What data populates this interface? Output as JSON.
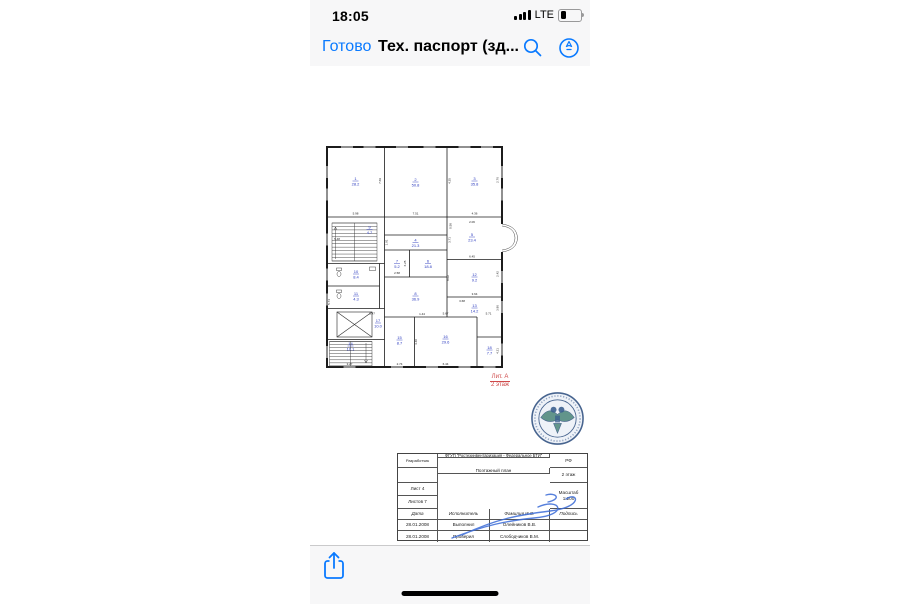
{
  "status_bar": {
    "time": "18:05",
    "network": "LTE",
    "battery_level": 0.3
  },
  "nav_bar": {
    "done_label": "Готово",
    "title": "Тех. паспорт (зд..."
  },
  "plan": {
    "floor_label_line1": "Лит. А",
    "floor_label_line2": "2 этаж",
    "label_color": "#cf4a4a",
    "room_label_color": "#2b3bbf",
    "rooms": [
      {
        "n": "1",
        "a": "28.2",
        "x": 67,
        "y": 78
      },
      {
        "n": "2",
        "a": "50.8",
        "x": 187,
        "y": 80
      },
      {
        "n": "3",
        "a": "35.8",
        "x": 305,
        "y": 78
      },
      {
        "n": "4",
        "a": "21.3",
        "x": 187,
        "y": 201
      },
      {
        "n": "5",
        "a": "23.4",
        "x": 300,
        "y": 190
      },
      {
        "n": "6",
        "a": "18.8",
        "x": 212,
        "y": 243
      },
      {
        "n": "7",
        "a": "5.2",
        "x": 150,
        "y": 243
      },
      {
        "n": "8",
        "a": "36.9",
        "x": 187,
        "y": 308
      },
      {
        "n": "9",
        "a": "4.7",
        "x": 95,
        "y": 175
      },
      {
        "n": "10",
        "a": "8.4",
        "x": 68,
        "y": 264
      },
      {
        "n": "11",
        "a": "4.3",
        "x": 68,
        "y": 308
      },
      {
        "n": "12",
        "a": "9.2",
        "x": 305,
        "y": 270
      },
      {
        "n": "13",
        "a": "14.2",
        "x": 305,
        "y": 332
      },
      {
        "n": "14",
        "a": "10.1",
        "x": 57,
        "y": 408
      },
      {
        "n": "15",
        "a": "8.7",
        "x": 155,
        "y": 396
      },
      {
        "n": "16",
        "a": "29.6",
        "x": 247,
        "y": 394
      },
      {
        "n": "17",
        "a": "10.0",
        "x": 112,
        "y": 362
      },
      {
        "n": "18",
        "a": "7.7",
        "x": 335,
        "y": 416
      }
    ],
    "dims": [
      {
        "v": "5.98",
        "x": 67,
        "y": 145
      },
      {
        "v": "7.69",
        "x": 118,
        "y": 78,
        "r": -90
      },
      {
        "v": "7.51",
        "x": 187,
        "y": 145
      },
      {
        "v": "1.91",
        "x": 131,
        "y": 201,
        "r": -90
      },
      {
        "v": "4.25",
        "x": 257,
        "y": 78,
        "r": -90
      },
      {
        "v": "2.76",
        "x": 353,
        "y": 76,
        "r": -90
      },
      {
        "v": "4.36",
        "x": 305,
        "y": 145
      },
      {
        "v": "5.48",
        "x": 30,
        "y": 196
      },
      {
        "v": "1.47",
        "x": 100,
        "y": 345
      },
      {
        "v": "2.06",
        "x": 300,
        "y": 162
      },
      {
        "v": "0.58",
        "x": 259,
        "y": 168,
        "r": -90
      },
      {
        "v": "3.71",
        "x": 257,
        "y": 196,
        "r": -90
      },
      {
        "v": "6.45",
        "x": 300,
        "y": 231
      },
      {
        "v": "6.25",
        "x": 168,
        "y": 243,
        "r": -90
      },
      {
        "v": "2.58",
        "x": 150,
        "y": 264
      },
      {
        "v": "3.64",
        "x": 305,
        "y": 306
      },
      {
        "v": "2.42",
        "x": 353,
        "y": 264,
        "r": -90
      },
      {
        "v": "8.02",
        "x": 254,
        "y": 272,
        "r": -90
      },
      {
        "v": "3.86",
        "x": 353,
        "y": 332,
        "r": -90
      },
      {
        "v": "3.68",
        "x": 280,
        "y": 320
      },
      {
        "v": "5.71",
        "x": 333,
        "y": 345
      },
      {
        "v": "1.44",
        "x": 200,
        "y": 346
      },
      {
        "v": "5.67",
        "x": 247,
        "y": 345
      },
      {
        "v": "4.40",
        "x": 190,
        "y": 400,
        "r": -90
      },
      {
        "v": "6.44",
        "x": 247,
        "y": 446
      },
      {
        "v": "2.74",
        "x": 155,
        "y": 446
      },
      {
        "v": "4.21",
        "x": 353,
        "y": 418,
        "r": -90
      },
      {
        "v": "3.27",
        "x": 55,
        "y": 446
      },
      {
        "v": "5.74",
        "x": 16,
        "y": 320,
        "r": -90
      }
    ]
  },
  "title_block": {
    "developer_label": "Разработчик",
    "organization": "ФГУП \"Ростехинвентаризация - Федеральное БТИ\"",
    "country": "РФ",
    "plan_type": "Поэтажный план",
    "floor": "2 этаж",
    "sheet": "Лист 4",
    "sheets_total": "Листов 7",
    "scale_label": "Масштаб",
    "scale_value": "1:200",
    "col_date": "Дата",
    "col_role": "Исполнитель",
    "col_name": "Фамилия И.О.",
    "col_sign": "Подпись",
    "rows": [
      {
        "date": "28.01.2008",
        "role": "Выполнил",
        "name": "Олейников В.В."
      },
      {
        "date": "28.01.2008",
        "role": "Проверил",
        "name": "Слободчиков В.М."
      }
    ],
    "page_number": "1"
  }
}
